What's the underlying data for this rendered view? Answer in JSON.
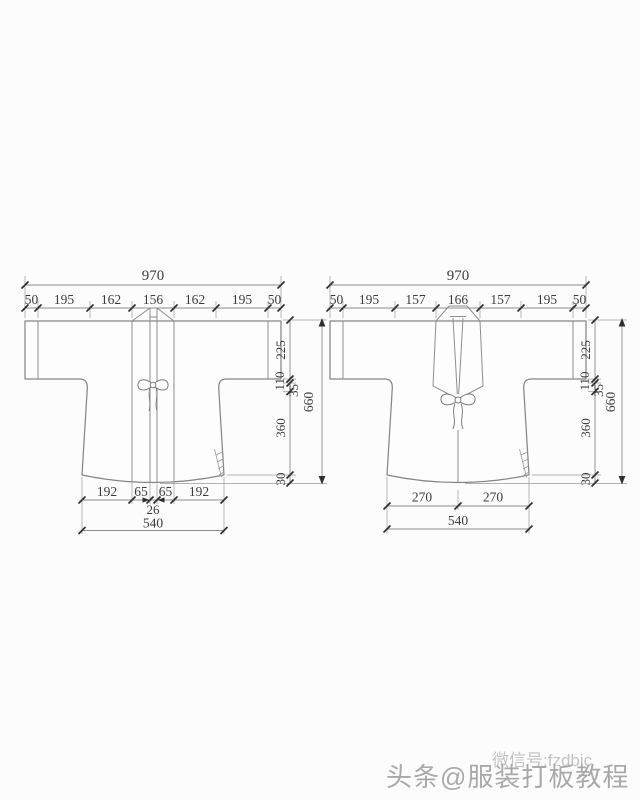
{
  "left_garment": {
    "top_total": "970",
    "top_segments": [
      "50",
      "195",
      "162",
      "156",
      "162",
      "195",
      "50"
    ],
    "side_segments": [
      "225",
      "110",
      "35",
      "360",
      "30"
    ],
    "side_total": "660",
    "hem_segments": [
      "192",
      "65",
      "65",
      "192"
    ],
    "hem_center": "26",
    "hem_total": "540"
  },
  "right_garment": {
    "top_total": "970",
    "top_segments": [
      "50",
      "195",
      "157",
      "166",
      "157",
      "195",
      "50"
    ],
    "side_segments": [
      "225",
      "110",
      "35",
      "360",
      "30"
    ],
    "side_total": "660",
    "hem_segments": [
      "270",
      "270"
    ],
    "hem_total": "540"
  },
  "watermark": {
    "wechat": "微信号:fzdbjc",
    "toutiao": "头条@服装打板教程"
  },
  "colors": {
    "background": "#fcfcfc",
    "line": "#8b8b8b",
    "dim_text": "#3c3c3c",
    "watermark": "#a9a9a9"
  }
}
